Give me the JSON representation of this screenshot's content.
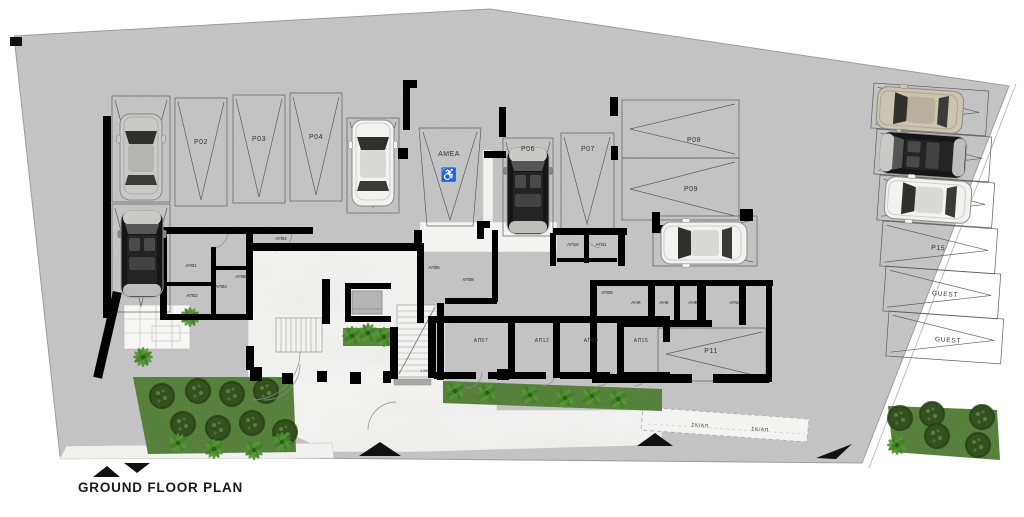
{
  "title": "GROUND FLOOR PLAN",
  "parking": {
    "p02": "P02",
    "p03": "P03",
    "p04": "P04",
    "p06": "P06",
    "p07": "P07",
    "p08": "P08",
    "p09": "P09",
    "p11": "P11",
    "p15": "P15",
    "guest_a": "GUEST",
    "guest_b": "GUEST",
    "amea": "AMEA"
  },
  "storage": {
    "ap01": "ΑΠ01",
    "ap02": "ΑΠ02",
    "ap03": "ΑΠ03",
    "ap04": "ΑΠ04",
    "ap05": "ΑΠ05",
    "ap06": "ΑΠ06",
    "ap07": "ΑΠ07",
    "ap08": "ΑΠ08",
    "ap09": "ΑΠ09",
    "ap10": "ΑΠ10",
    "ap11": "ΑΠ11",
    "ap12": "ΑΠ12",
    "ap13": "ΑΠ13",
    "ap15": "ΑΠ15",
    "ap16": "ΑΠ16"
  },
  "mechanical": {
    "ahk_a": "AHK",
    "ahk_b": "AHK",
    "ahk_c": "AHK"
  },
  "ramp": {
    "skap_a": "ΣΚ/ΑΠ",
    "skap_b": "ΣΚ/ΑΠ"
  },
  "dimensions": {
    "stair_width": "1.50"
  },
  "icons": {
    "wheelchair": "♿"
  },
  "colors": {
    "site_concrete": "#c6c6c6",
    "wall": "#000000",
    "marble": "#f4f4f2",
    "grass": "#4e7a33",
    "tree": "#33511f",
    "accent_black": "#111111"
  }
}
